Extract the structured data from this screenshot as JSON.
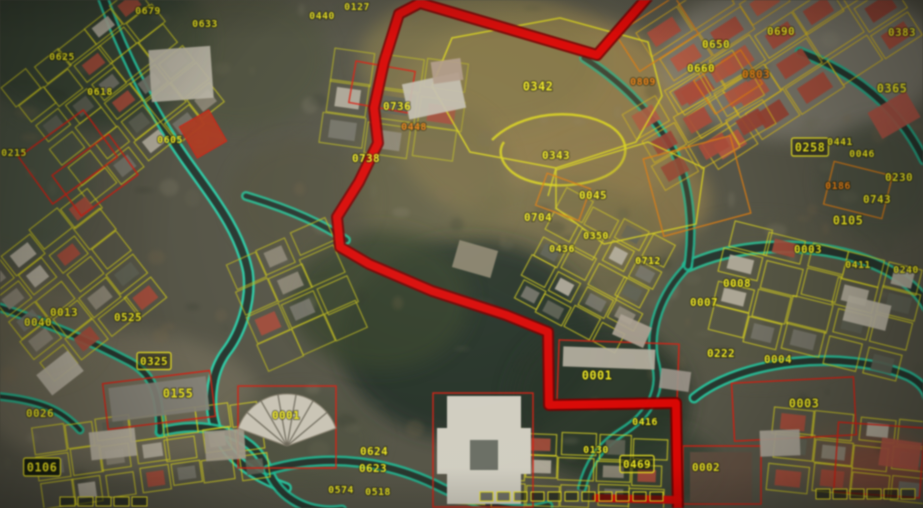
{
  "map": {
    "width": 923,
    "height": 508,
    "colors": {
      "ground": "#555446",
      "label_yellow": "#e8e13a",
      "label_orange": "#db8228",
      "parcel_yellow": "#d2cc34",
      "parcel_red": "#c5281c",
      "parcel_orange": "#cf7d22",
      "road_dark": "#2c332d",
      "road_edge_teal": "#38c7a4",
      "route_red": "#c81210",
      "route_dark": "#6e0606"
    },
    "labels": [
      {
        "t": "0679",
        "x": 148,
        "y": 11,
        "s": 8,
        "c": "y"
      },
      {
        "t": "0127",
        "x": 357,
        "y": 7,
        "s": 8,
        "c": "y"
      },
      {
        "t": "0440",
        "x": 322,
        "y": 16,
        "s": 8,
        "c": "y"
      },
      {
        "t": "0633",
        "x": 205,
        "y": 24,
        "s": 8,
        "c": "y"
      },
      {
        "t": "0650",
        "x": 716,
        "y": 45,
        "s": 9,
        "c": "y"
      },
      {
        "t": "0690",
        "x": 781,
        "y": 32,
        "s": 9,
        "c": "y"
      },
      {
        "t": "0383",
        "x": 902,
        "y": 33,
        "s": 9,
        "c": "y"
      },
      {
        "t": "0660",
        "x": 701,
        "y": 69,
        "s": 9,
        "c": "y"
      },
      {
        "t": "0809",
        "x": 643,
        "y": 82,
        "s": 8,
        "c": "o"
      },
      {
        "t": "0803",
        "x": 756,
        "y": 75,
        "s": 9,
        "c": "o"
      },
      {
        "t": "0365",
        "x": 892,
        "y": 89,
        "s": 10,
        "c": "y"
      },
      {
        "t": "0625",
        "x": 62,
        "y": 57,
        "s": 8,
        "c": "y"
      },
      {
        "t": "0618",
        "x": 100,
        "y": 92,
        "s": 8,
        "c": "y"
      },
      {
        "t": "0605",
        "x": 170,
        "y": 140,
        "s": 8,
        "c": "y"
      },
      {
        "t": "0736",
        "x": 397,
        "y": 107,
        "s": 9,
        "c": "y"
      },
      {
        "t": "0448",
        "x": 414,
        "y": 127,
        "s": 8,
        "c": "o"
      },
      {
        "t": "0342",
        "x": 538,
        "y": 87,
        "s": 10,
        "c": "y"
      },
      {
        "t": "0343",
        "x": 556,
        "y": 156,
        "s": 9,
        "c": "y"
      },
      {
        "t": "0738",
        "x": 366,
        "y": 159,
        "s": 9,
        "c": "y"
      },
      {
        "t": "0258",
        "x": 810,
        "y": 148,
        "s": 10,
        "c": "y",
        "b": "box"
      },
      {
        "t": "0441",
        "x": 840,
        "y": 142,
        "s": 8,
        "c": "y"
      },
      {
        "t": "0046",
        "x": 862,
        "y": 154,
        "s": 8,
        "c": "y"
      },
      {
        "t": "0230",
        "x": 899,
        "y": 178,
        "s": 9,
        "c": "y"
      },
      {
        "t": "0743",
        "x": 877,
        "y": 200,
        "s": 9,
        "c": "y"
      },
      {
        "t": "0186",
        "x": 838,
        "y": 186,
        "s": 8,
        "c": "o"
      },
      {
        "t": "0105",
        "x": 848,
        "y": 221,
        "s": 10,
        "c": "y"
      },
      {
        "t": "0045",
        "x": 593,
        "y": 196,
        "s": 9,
        "c": "y"
      },
      {
        "t": "0704",
        "x": 538,
        "y": 218,
        "s": 9,
        "c": "y"
      },
      {
        "t": "0350",
        "x": 596,
        "y": 236,
        "s": 8,
        "c": "y"
      },
      {
        "t": "0436",
        "x": 562,
        "y": 249,
        "s": 8,
        "c": "y"
      },
      {
        "t": "0712",
        "x": 648,
        "y": 261,
        "s": 8,
        "c": "y"
      },
      {
        "t": "0215",
        "x": 14,
        "y": 153,
        "s": 8,
        "c": "y"
      },
      {
        "t": "0013",
        "x": 64,
        "y": 313,
        "s": 9,
        "c": "y"
      },
      {
        "t": "0040",
        "x": 38,
        "y": 323,
        "s": 9,
        "c": "y"
      },
      {
        "t": "0525",
        "x": 128,
        "y": 318,
        "s": 9,
        "c": "y"
      },
      {
        "t": "0325",
        "x": 154,
        "y": 362,
        "s": 9,
        "c": "y",
        "b": "box"
      },
      {
        "t": "0003",
        "x": 808,
        "y": 250,
        "s": 9,
        "c": "y"
      },
      {
        "t": "0411",
        "x": 858,
        "y": 265,
        "s": 8,
        "c": "y"
      },
      {
        "t": "0240",
        "x": 906,
        "y": 270,
        "s": 8,
        "c": "y"
      },
      {
        "t": "0008",
        "x": 737,
        "y": 284,
        "s": 9,
        "c": "y"
      },
      {
        "t": "0007",
        "x": 704,
        "y": 303,
        "s": 9,
        "c": "y"
      },
      {
        "t": "0001",
        "x": 597,
        "y": 376,
        "s": 10,
        "c": "y"
      },
      {
        "t": "0222",
        "x": 721,
        "y": 354,
        "s": 9,
        "c": "y"
      },
      {
        "t": "0004",
        "x": 778,
        "y": 360,
        "s": 9,
        "c": "y"
      },
      {
        "t": "0003",
        "x": 804,
        "y": 404,
        "s": 10,
        "c": "y"
      },
      {
        "t": "0002",
        "x": 706,
        "y": 468,
        "s": 9,
        "c": "y"
      },
      {
        "t": "0469",
        "x": 637,
        "y": 465,
        "s": 9,
        "c": "y",
        "b": "box"
      },
      {
        "t": "0416",
        "x": 645,
        "y": 422,
        "s": 8,
        "c": "y"
      },
      {
        "t": "0130",
        "x": 596,
        "y": 450,
        "s": 8,
        "c": "y"
      },
      {
        "t": "0624",
        "x": 374,
        "y": 452,
        "s": 9,
        "c": "y"
      },
      {
        "t": "0623",
        "x": 373,
        "y": 469,
        "s": 9,
        "c": "y"
      },
      {
        "t": "0574",
        "x": 341,
        "y": 490,
        "s": 8,
        "c": "y"
      },
      {
        "t": "0518",
        "x": 378,
        "y": 492,
        "s": 8,
        "c": "y"
      },
      {
        "t": "0001",
        "x": 286,
        "y": 416,
        "s": 9,
        "c": "y"
      },
      {
        "t": "0155",
        "x": 178,
        "y": 394,
        "s": 10,
        "c": "y"
      },
      {
        "t": "0026",
        "x": 40,
        "y": 414,
        "s": 9,
        "c": "y"
      },
      {
        "t": "0106",
        "x": 42,
        "y": 468,
        "s": 10,
        "c": "y",
        "b": "dark"
      }
    ],
    "route": {
      "width": 8,
      "points": [
        [
          652,
          -8
        ],
        [
          597,
          55
        ],
        [
          420,
          3
        ],
        [
          399,
          14
        ],
        [
          384,
          62
        ],
        [
          374,
          108
        ],
        [
          378,
          143
        ],
        [
          359,
          182
        ],
        [
          337,
          217
        ],
        [
          340,
          247
        ],
        [
          369,
          264
        ],
        [
          432,
          291
        ],
        [
          506,
          315
        ],
        [
          548,
          332
        ],
        [
          549,
          405
        ],
        [
          676,
          403
        ],
        [
          678,
          514
        ]
      ],
      "stub": [
        [
          596,
          498
        ],
        [
          678,
          500
        ]
      ]
    },
    "roads": [
      {
        "d": "M 100,-10 C 122,52 152,112 186,160 C 216,202 240,232 248,272 C 252,302 240,334 226,352 C 210,374 206,410 220,438 C 232,462 258,478 286,488",
        "w": 7,
        "e": "#3ad0ae"
      },
      {
        "d": "M 246,196 C 286,208 320,222 346,240",
        "w": 5,
        "e": "#35b895"
      },
      {
        "d": "M 160,432 C 202,420 252,430 268,470 C 280,500 310,514 342,510",
        "w": 6,
        "e": "#35c2a0"
      },
      {
        "d": "M 268,470 C 330,452 392,462 442,488 C 482,508 522,514 548,506",
        "w": 6,
        "e": "#2fb292"
      },
      {
        "d": "M 688,266 C 732,246 792,240 852,256 C 894,268 918,288 928,308",
        "w": 8,
        "e": "#38b894"
      },
      {
        "d": "M 694,398 C 740,360 844,348 908,376 C 920,382 926,390 928,398",
        "w": 6,
        "e": "#35c2a0"
      },
      {
        "d": "M 688,266 C 662,292 646,330 656,366 C 662,392 648,416 622,432 C 600,446 588,464 582,488",
        "w": 5,
        "e": "#2fae8e"
      },
      {
        "d": "M 800,52 C 858,74 900,110 924,160",
        "w": 6,
        "e": "#2fa88a"
      },
      {
        "d": "M 584,58 C 622,82 652,112 674,152 C 690,184 694,228 688,266",
        "w": 5,
        "e": "#2fae8e"
      },
      {
        "d": "M -5,306 C 46,322 92,342 130,362 C 152,374 160,392 160,432",
        "w": 5,
        "e": "#32b593"
      },
      {
        "d": "M -5,396 C 40,400 62,410 80,430",
        "w": 4,
        "e": "#32b593"
      }
    ],
    "patches": [
      {
        "x": 90,
        "y": 40,
        "rx": 120,
        "ry": 90,
        "f": "#3a4438",
        "o": 0.9
      },
      {
        "x": 20,
        "y": 180,
        "rx": 70,
        "ry": 80,
        "f": "#4a5244",
        "o": 0.7
      },
      {
        "x": 240,
        "y": 60,
        "rx": 90,
        "ry": 70,
        "f": "#50523f",
        "o": 0.6
      },
      {
        "x": 540,
        "y": 120,
        "rx": 150,
        "ry": 110,
        "f": "#8c7b55",
        "o": 0.95
      },
      {
        "x": 480,
        "y": 60,
        "rx": 120,
        "ry": 70,
        "f": "#7e744f",
        "o": 0.8
      },
      {
        "x": 620,
        "y": 200,
        "rx": 90,
        "ry": 60,
        "f": "#8a7a52",
        "o": 0.8
      },
      {
        "x": 560,
        "y": 250,
        "rx": 110,
        "ry": 70,
        "f": "#6f6b4c",
        "o": 0.7
      },
      {
        "x": 430,
        "y": 180,
        "rx": 80,
        "ry": 80,
        "f": "#6b6647",
        "o": 0.6
      },
      {
        "x": 470,
        "y": 340,
        "rx": 130,
        "ry": 100,
        "f": "#28322a",
        "o": 0.9
      },
      {
        "x": 600,
        "y": 400,
        "rx": 90,
        "ry": 80,
        "f": "#2c362c",
        "o": 0.85
      },
      {
        "x": 380,
        "y": 300,
        "rx": 90,
        "ry": 70,
        "f": "#37432f",
        "o": 0.8
      },
      {
        "x": 300,
        "y": 200,
        "rx": 70,
        "ry": 60,
        "f": "#55523f",
        "o": 0.5
      },
      {
        "x": 800,
        "y": 60,
        "rx": 140,
        "ry": 80,
        "f": "#8e8a80",
        "o": 0.6
      },
      {
        "x": 880,
        "y": 180,
        "rx": 60,
        "ry": 60,
        "f": "#4a4f43",
        "o": 0.6
      },
      {
        "x": 760,
        "y": 300,
        "rx": 120,
        "ry": 80,
        "f": "#5a5a4a",
        "o": 0.5
      },
      {
        "x": 120,
        "y": 400,
        "rx": 140,
        "ry": 70,
        "f": "#7a7464",
        "o": 0.6
      },
      {
        "x": 40,
        "y": 330,
        "rx": 60,
        "ry": 50,
        "f": "#6e6a58",
        "o": 0.6
      },
      {
        "x": 300,
        "y": 440,
        "rx": 80,
        "ry": 50,
        "f": "#4f5242",
        "o": 0.5
      },
      {
        "x": 860,
        "y": 460,
        "rx": 70,
        "ry": 40,
        "f": "#6a5a4a",
        "o": 0.5
      },
      {
        "x": 660,
        "y": 470,
        "rx": 60,
        "ry": 40,
        "f": "#333c30",
        "o": 0.7
      },
      {
        "x": 880,
        "y": 470,
        "rx": 50,
        "ry": 30,
        "f": "#8a4a3a",
        "o": 0.55
      }
    ],
    "clusters": [
      {
        "cx": 115,
        "cy": 95,
        "rot": -38,
        "cols": 5,
        "rows": 6,
        "cw": 34,
        "ch": 25,
        "stroke": "#c8c433",
        "p": 0.45,
        "terra": false
      },
      {
        "cx": 70,
        "cy": 285,
        "rot": -38,
        "cols": 4,
        "rows": 5,
        "cw": 36,
        "ch": 27,
        "stroke": "#cac62f",
        "p": 0.5,
        "terra": false
      },
      {
        "cx": 150,
        "cy": 452,
        "rot": -8,
        "cols": 7,
        "rows": 3,
        "cw": 33,
        "ch": 27,
        "stroke": "#d4cf36",
        "p": 0.55,
        "terra": false
      },
      {
        "cx": 395,
        "cy": 105,
        "rot": 8,
        "cols": 3,
        "rows": 3,
        "cw": 46,
        "ch": 34,
        "stroke": "#b7b433",
        "p": 0.3,
        "terra": false
      },
      {
        "cx": 795,
        "cy": 62,
        "rot": -33,
        "cols": 5,
        "rows": 3,
        "cw": 50,
        "ch": 32,
        "stroke": "#d2b82e",
        "p": 0.95,
        "terra": true
      },
      {
        "cx": 715,
        "cy": 18,
        "rot": -33,
        "cols": 3,
        "rows": 2,
        "cw": 48,
        "ch": 30,
        "stroke": "#c9a42c",
        "p": 0.9,
        "terra": true
      },
      {
        "cx": 700,
        "cy": 120,
        "rot": -30,
        "cols": 3,
        "rows": 3,
        "cw": 44,
        "ch": 30,
        "stroke": "#cdb42f",
        "p": 0.8,
        "terra": true
      },
      {
        "cx": 815,
        "cy": 300,
        "rot": 14,
        "cols": 5,
        "rows": 4,
        "cw": 40,
        "ch": 29,
        "stroke": "#d4cf36",
        "p": 0.6,
        "terra": false
      },
      {
        "cx": 592,
        "cy": 272,
        "rot": 28,
        "cols": 4,
        "rows": 5,
        "cw": 31,
        "ch": 25,
        "stroke": "#cfc832",
        "p": 0.5,
        "terra": false
      },
      {
        "cx": 560,
        "cy": 470,
        "rot": 2,
        "cols": 6,
        "rows": 3,
        "cw": 35,
        "ch": 26,
        "stroke": "#d8d23a",
        "p": 0.55,
        "terra": false
      },
      {
        "cx": 852,
        "cy": 455,
        "rot": 6,
        "cols": 4,
        "rows": 3,
        "cw": 40,
        "ch": 28,
        "stroke": "#d0ca34",
        "p": 0.6,
        "terra": false
      },
      {
        "cx": 296,
        "cy": 296,
        "rot": -24,
        "cols": 3,
        "rows": 4,
        "cw": 38,
        "ch": 30,
        "stroke": "#b9b530",
        "p": 0.35,
        "terra": false
      }
    ],
    "yellow_paths": [
      {
        "d": "M 432,86 L 452,38 L 560,18 L 648,42 L 662,96 L 636,142 L 556,168 L 470,152 Z",
        "fill": "rgba(140,120,70,0.25)",
        "w": 1.6
      },
      {
        "d": "M 492,140 C 520,112 576,106 610,126 C 632,140 630,164 606,176 C 576,190 532,188 512,172 C 500,162 498,150 504,142",
        "fill": "none",
        "w": 2.5
      },
      {
        "d": "M 556,170 L 648,142 L 704,168 L 696,224 L 604,244 L 556,208 Z",
        "fill": "rgba(130,110,65,0.18)",
        "w": 1.4
      },
      {
        "d": "M 556,168 L 548,196",
        "fill": "none",
        "w": 1.4
      }
    ],
    "red_parcels": [
      [
        28,
        128,
        80,
        58,
        -36
      ],
      [
        60,
        150,
        70,
        50,
        -36
      ],
      [
        105,
        377,
        108,
        46,
        -7
      ],
      [
        558,
        342,
        120,
        62,
        2
      ],
      [
        733,
        380,
        122,
        58,
        -3
      ],
      [
        683,
        446,
        78,
        58,
        0
      ],
      [
        433,
        393,
        100,
        114,
        0
      ],
      [
        238,
        386,
        98,
        82,
        0
      ],
      [
        352,
        66,
        60,
        42,
        10
      ],
      [
        836,
        425,
        86,
        70,
        4
      ]
    ],
    "red_filled": [
      [
        186,
        116,
        34,
        36,
        -30
      ]
    ],
    "orange_parcels": [
      [
        622,
        12,
        70,
        44,
        -33
      ],
      [
        700,
        62,
        56,
        40,
        -33
      ],
      [
        652,
        146,
        90,
        80,
        -15
      ],
      [
        828,
        168,
        60,
        44,
        14
      ],
      [
        540,
        180,
        46,
        34,
        20
      ]
    ],
    "buildings": [
      [
        150,
        48,
        62,
        52,
        -4,
        "#b6b2a5"
      ],
      [
        405,
        78,
        58,
        36,
        -12,
        "#c0bcb0"
      ],
      [
        563,
        348,
        92,
        20,
        2,
        "#b2ada0"
      ],
      [
        110,
        382,
        98,
        34,
        -7,
        "#85827a"
      ],
      [
        690,
        452,
        62,
        50,
        0,
        "#5f5044"
      ],
      [
        872,
        100,
        44,
        30,
        -30,
        "#a3574a"
      ],
      [
        40,
        360,
        40,
        26,
        -38,
        "#b0aa9c"
      ],
      [
        90,
        430,
        46,
        28,
        -6,
        "#b4ae9f"
      ],
      [
        205,
        430,
        40,
        30,
        -4,
        "#9f998c"
      ],
      [
        455,
        245,
        40,
        28,
        16,
        "#8c8672"
      ],
      [
        615,
        320,
        34,
        22,
        24,
        "#a89f92"
      ],
      [
        660,
        370,
        30,
        20,
        8,
        "#99938a"
      ],
      [
        760,
        430,
        40,
        26,
        -2,
        "#a5a095"
      ],
      [
        880,
        440,
        40,
        28,
        8,
        "#a3584a"
      ],
      [
        845,
        300,
        44,
        26,
        14,
        "#b5b0a2"
      ],
      [
        432,
        60,
        30,
        22,
        -8,
        "#ad9a8a"
      ]
    ],
    "landmarks": {
      "fan": {
        "cx": 287,
        "cy": 446,
        "r": 52,
        "a0": 200,
        "a1": 340,
        "fill": "#c5c1b4"
      },
      "mosque": {
        "x": 447,
        "y": 396,
        "w": 74,
        "h": 108,
        "wing_x": 437,
        "wing_y": 428,
        "wing_w": 94,
        "wing_h": 46,
        "fill": "#ccc9be"
      }
    },
    "unit_rows": [
      {
        "x": 480,
        "y": 492,
        "n": 11,
        "dx": 17,
        "w": 13,
        "h": 9
      },
      {
        "x": 816,
        "y": 489,
        "n": 6,
        "dx": 17,
        "w": 14,
        "h": 10
      },
      {
        "x": 60,
        "y": 497,
        "n": 5,
        "dx": 18,
        "w": 15,
        "h": 9
      }
    ]
  }
}
